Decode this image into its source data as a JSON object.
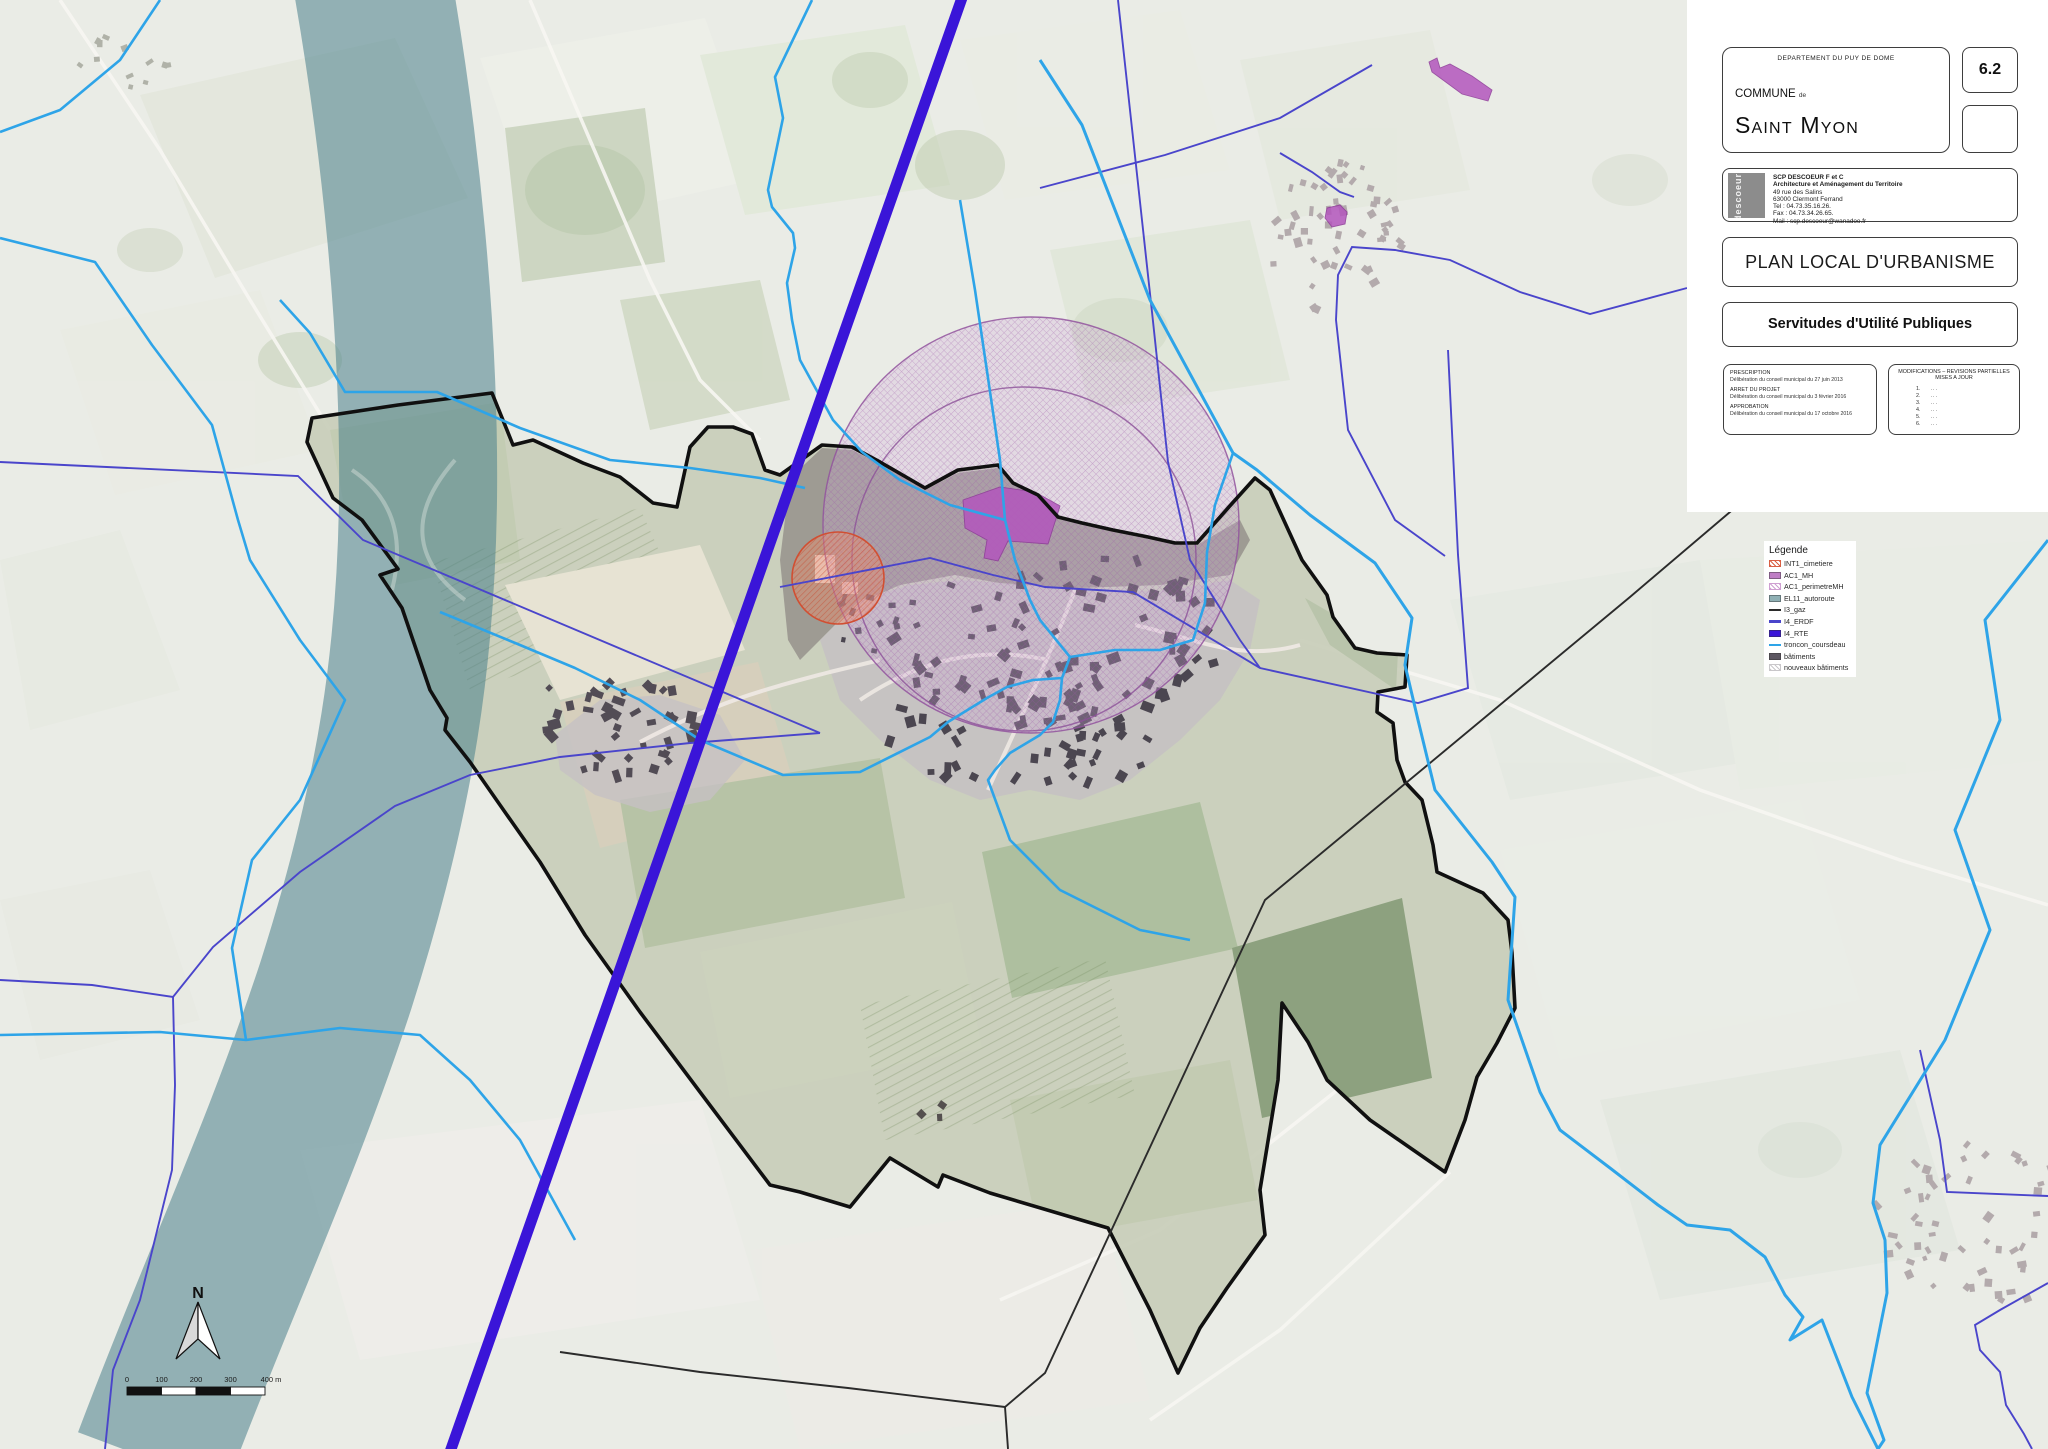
{
  "panel": {
    "department_label": "DEPARTEMENT DU PUY DE DOME",
    "commune_label": "COMMUNE",
    "commune_de": "de",
    "commune_name": "Saint Myon",
    "plan_number": "6.2",
    "firm": {
      "logo_text": "descoeur",
      "name": "SCP DESCOEUR F et C",
      "line2": "Architecture et Aménagement du Territoire",
      "address1": "49 rue des Salins",
      "address2": "63000 Clermont Ferrand",
      "tel": "Tel : 04.73.35.16.26.",
      "fax": "Fax : 04.73.34.26.65.",
      "mail": "Mail : scp.descoeur@wanadoo.fr"
    },
    "doc_title": "PLAN LOCAL D'URBANISME",
    "doc_subtitle": "Servitudes d'Utilité Publiques",
    "prescription": {
      "h1": "PRESCRIPTION",
      "l1": "Délibération du conseil municipal du 27 juin 2013",
      "h2": "ARRET DU PROJET",
      "l2": "Délibération du conseil municipal du 3 février 2016",
      "h3": "APPROBATION",
      "l3": "Délibération du conseil municipal du 17 octobre 2016"
    },
    "modifications": {
      "title1": "MODIFICATIONS – REVISIONS PARTIELLES",
      "title2": "MISES A JOUR",
      "items": [
        "1.",
        "2.",
        "3.",
        "4.",
        "5.",
        "6."
      ],
      "dots": "..."
    }
  },
  "legend": {
    "title": "Légende",
    "items": [
      {
        "label": "INT1_cimetiere",
        "type": "hatch",
        "color": "#d95f43"
      },
      {
        "label": "AC1_MH",
        "type": "solid",
        "color": "#bf7ec5"
      },
      {
        "label": "AC1_perimetreMH",
        "type": "hatch",
        "color": "#cf9fd2"
      },
      {
        "label": "EL11_autoroute",
        "type": "solid",
        "color": "#8fb0b4"
      },
      {
        "label": "I3_gaz",
        "type": "line",
        "color": "#2b2b2b"
      },
      {
        "label": "I4_ERDF",
        "type": "line",
        "color": "#4a45cb"
      },
      {
        "label": "I4_RTE",
        "type": "solid",
        "color": "#3a15d8"
      },
      {
        "label": "troncon_coursdeau",
        "type": "line",
        "color": "#2ea4e8"
      },
      {
        "label": "bâtiments",
        "type": "solid",
        "color": "#5d5762"
      },
      {
        "label": "nouveaux bâtiments",
        "type": "hatch",
        "color": "#c9c7ca"
      }
    ]
  },
  "map": {
    "north_label": "N",
    "scale_ticks": [
      "0",
      "100",
      "200",
      "300",
      "400 m"
    ],
    "colors": {
      "autoroute_band": "#48808a",
      "perimeter_circle": "#b87fc0",
      "cimetiere_circle": "#d14f32",
      "monument_fill": "#b356bd",
      "boundary": "#101010"
    }
  }
}
